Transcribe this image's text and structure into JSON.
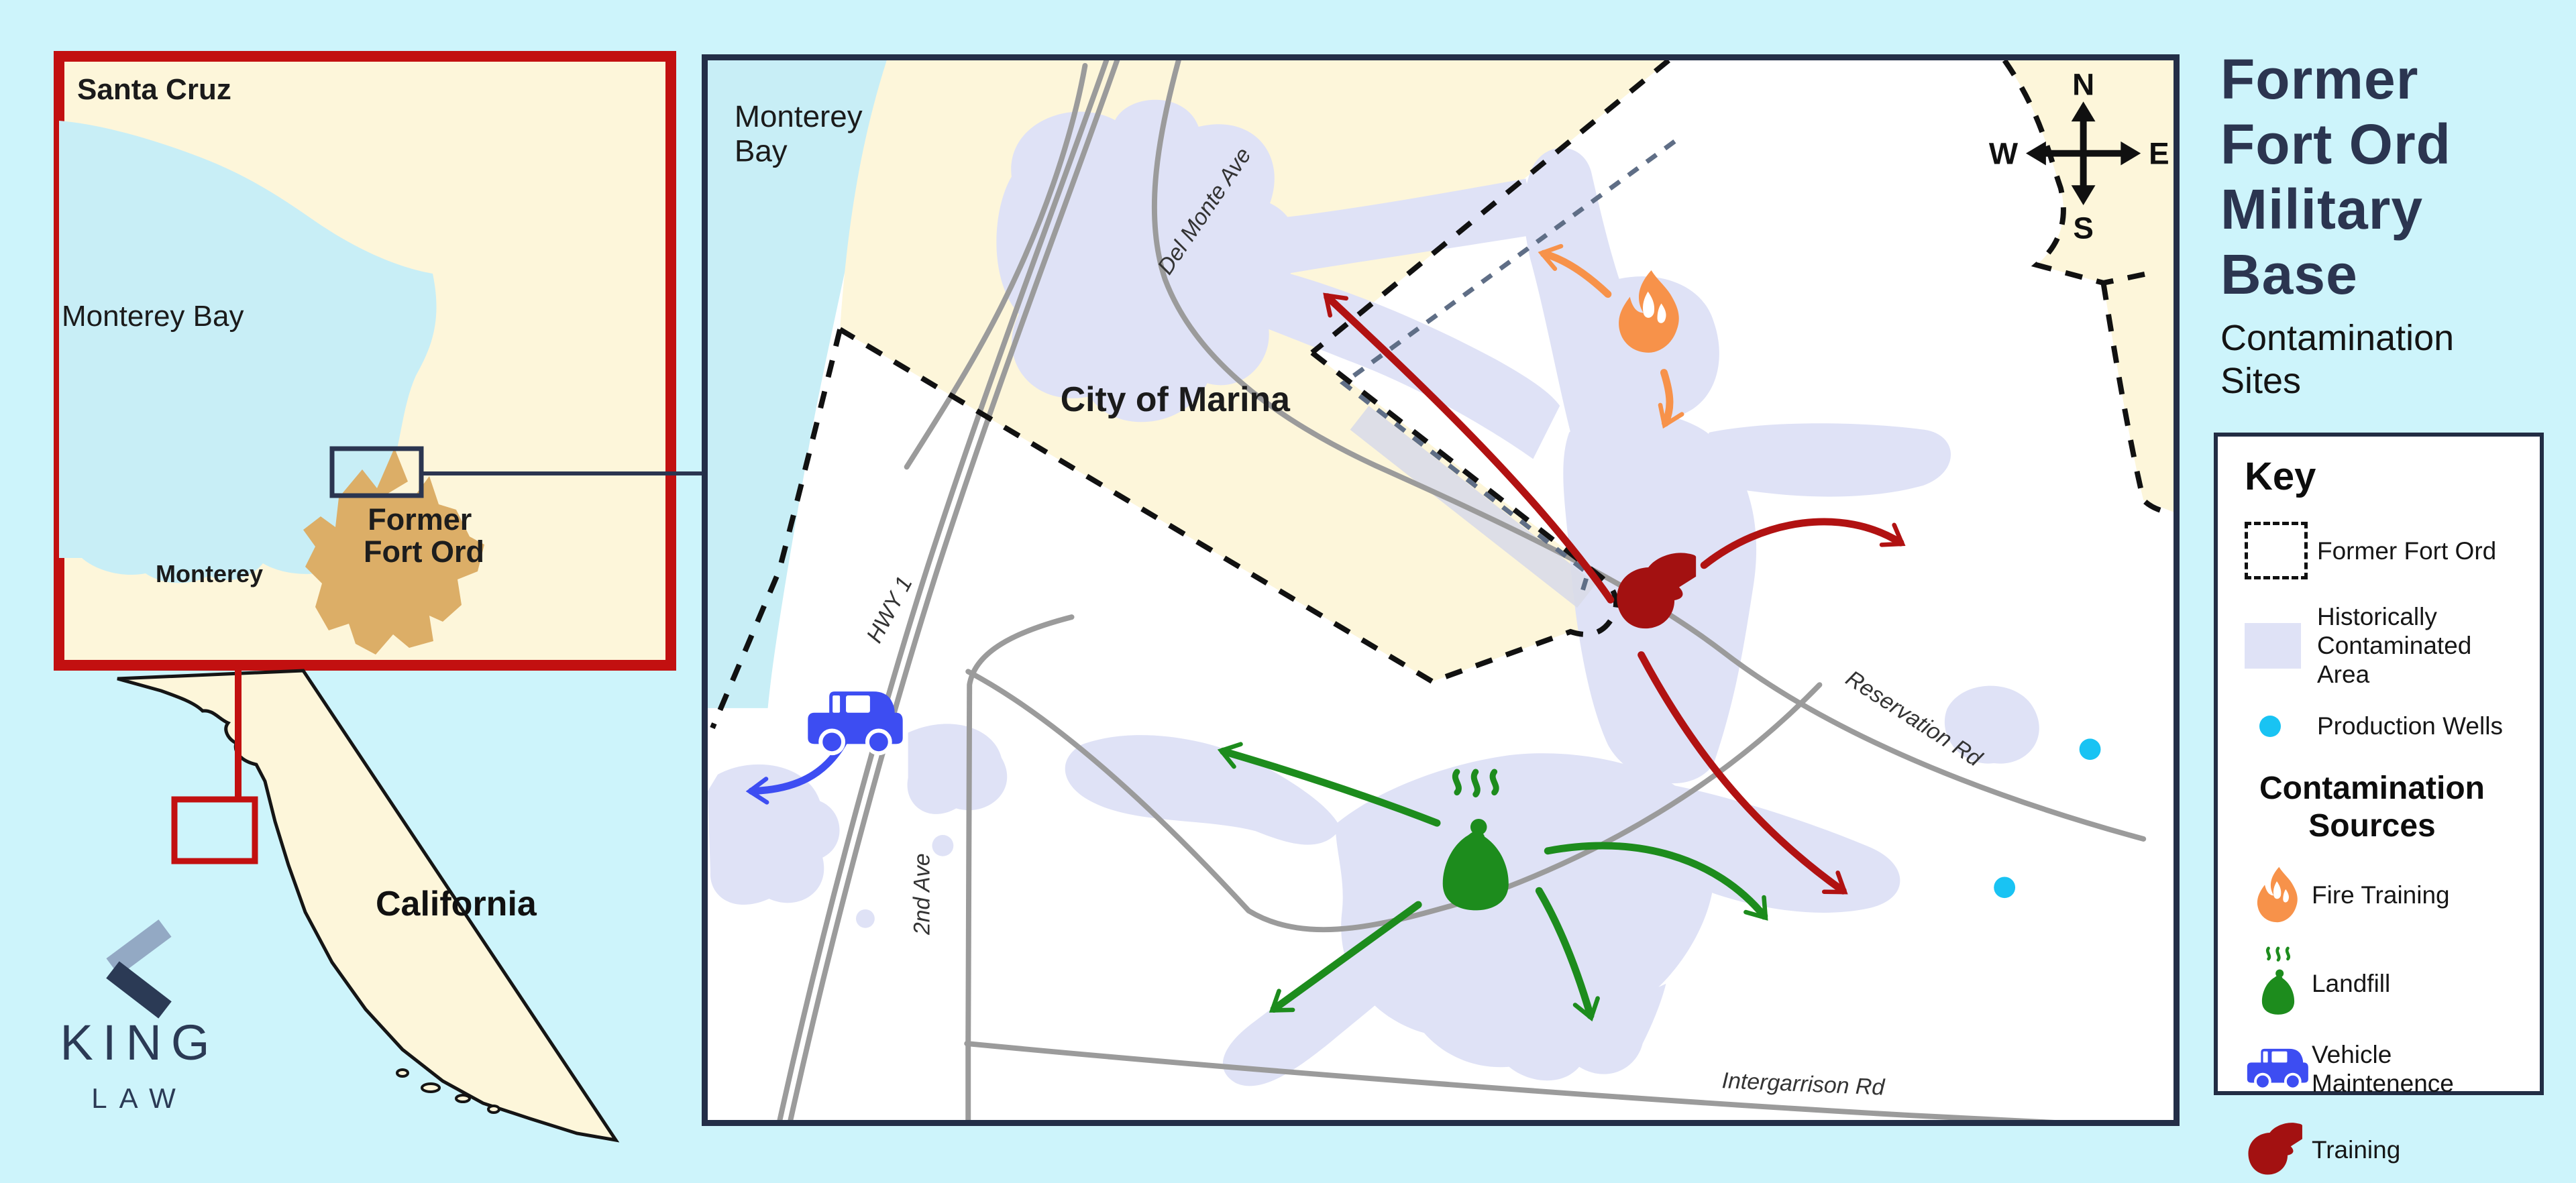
{
  "palette": {
    "background": "#cdf4fb",
    "land_cream": "#fdf6da",
    "bay_blue": "#c8eef6",
    "map_white": "#ffffff",
    "plume_lavender": "#dfe2f6",
    "road_gray": "#9b9b9b",
    "navy": "#2b3550",
    "red_border": "#c21010",
    "fort_tan": "#dcae67",
    "fire_orange": "#f7924a",
    "landfill_green": "#1d8c1d",
    "vehicle_blue": "#3d4df2",
    "training_red": "#a31111",
    "well_cyan": "#19c3f3"
  },
  "logo": {
    "name": "KING",
    "sub": "LAW"
  },
  "inset": {
    "santa_cruz": "Santa Cruz",
    "monterey_bay": "Monterey Bay",
    "monterey": "Monterey",
    "fort_ord_line1": "Former",
    "fort_ord_line2": "Fort Ord",
    "california": "California"
  },
  "map": {
    "bay_line1": "Monterey",
    "bay_line2": "Bay",
    "del_monte": "Del Monte Ave",
    "city": "City of Marina",
    "hwy": "HWY 1",
    "second_ave": "2nd Ave",
    "reservation": "Reservation Rd",
    "intergarrison": "Intergarrison Rd",
    "compass": {
      "n": "N",
      "e": "E",
      "s": "S",
      "w": "W"
    }
  },
  "panel": {
    "title_line1": "Former",
    "title_line2": "Fort Ord",
    "title_line3": "Military",
    "title_line4": "Base",
    "subtitle": "Contamination Sites"
  },
  "key": {
    "heading": "Key",
    "fort_ord": "Former Fort Ord",
    "contaminated_line1": "Historically",
    "contaminated_line2": "Contaminated Area",
    "wells": "Production Wells",
    "sources_heading_line1": "Contamination",
    "sources_heading_line2": "Sources",
    "fire": "Fire Training",
    "landfill": "Landfill",
    "vehicle_line1": "Vehicle",
    "vehicle_line2": "Maintenence",
    "training": "Training"
  }
}
